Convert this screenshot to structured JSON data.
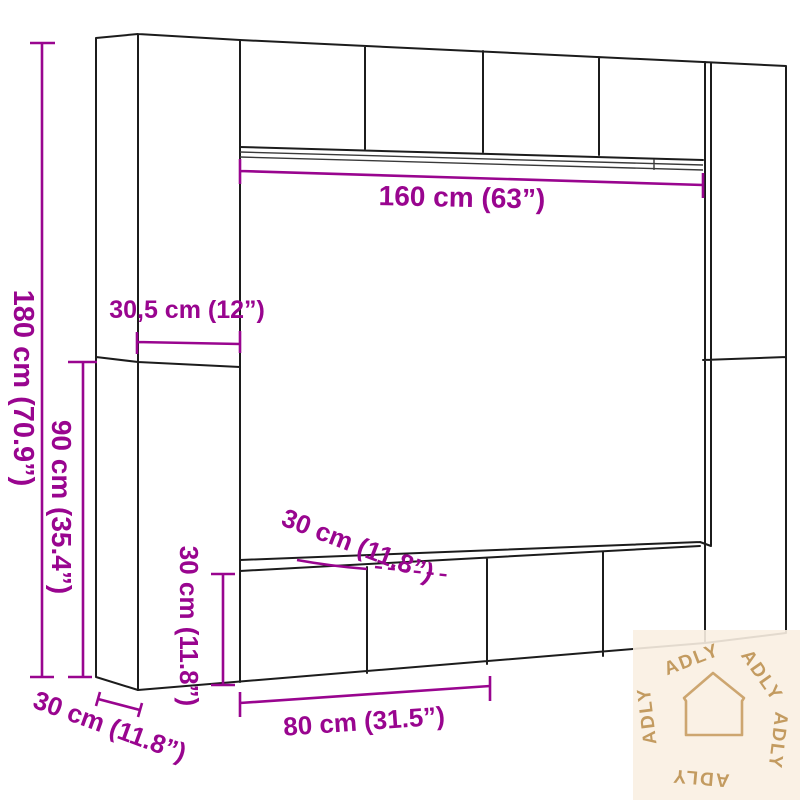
{
  "diagram": {
    "type": "furniture-dimension-diagram",
    "subject": "wall-mounted cabinet set (2 tall side columns, 4 top wall cabinets, 4 low cabinets)",
    "colors": {
      "dimension_accent": "#99058F",
      "drawing_outline": "#1C1C1C",
      "watermark_text": "#C39B60",
      "watermark_background": "#F9EFE2"
    },
    "dimensions": {
      "total_width": "160 cm (63”)",
      "column_width": "30,5 cm (12”)",
      "total_height": "180 cm (70.9”)",
      "column_half_height": "90 cm (35.4”)",
      "top_depth": "30 cm (11.8”)",
      "low_cabinet_height": "30 cm (11.8”)",
      "side_depth": "30 cm (11.8”)",
      "low_cabinet_width": "80 cm (31.5”)"
    },
    "watermark": {
      "word": "ADLY",
      "icon": "house-icon"
    }
  }
}
